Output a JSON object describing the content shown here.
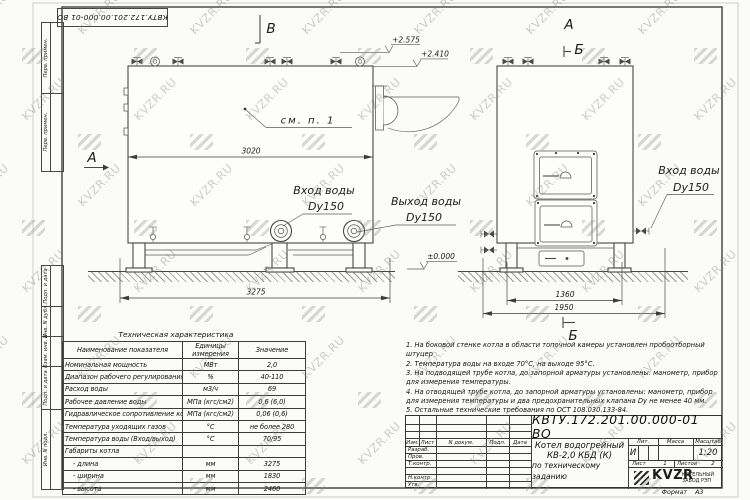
{
  "watermark": {
    "text": "KVZR.RU"
  },
  "margin": {
    "stamp": "КВТУ.172.201.00.000-01 ВО",
    "top_labels": [
      "Перв. примен.",
      "Перв. примен."
    ],
    "bottom_labels": [
      "Подп. и дата",
      "Инв. N дубл.",
      "Взам. инв. N",
      "Подп. и дата",
      "Инв. N подл."
    ]
  },
  "views": {
    "label_a_left": "А",
    "label_a_right": "А",
    "label_v_view": "В",
    "label_b_section_top": "Б",
    "label_b_section_bottom": "Б",
    "see_note": "см. п. 1",
    "dim_3020": "3020",
    "dim_3275": "3275",
    "dim_1360": "1360",
    "dim_1950": "1950",
    "elev_1": "+2.575",
    "elev_2": "+2.410",
    "elev_zero": "±0.000",
    "inlet_left_label": "Вход воды",
    "inlet_left_size": "Dy150",
    "outlet_label": "Выход воды",
    "outlet_size": "Dy150",
    "inlet_right_label": "Вход воды",
    "inlet_right_size": "Dy150"
  },
  "tech_table": {
    "title": "Техническая характеристика",
    "headers": [
      "Наименование показателя",
      "Единицы измерения",
      "Значение"
    ],
    "rows": [
      [
        "Номинальная мощность",
        "МВт",
        "2,0"
      ],
      [
        "Диапазон рабочего регулирования",
        "%",
        "40-110"
      ],
      [
        "Расход воды",
        "м3/ч",
        "69"
      ],
      [
        "Рабочее давление воды",
        "МПа (кгс/см2)",
        "0,6 (6,0)"
      ],
      [
        "Гидравлическое сопротивление котла",
        "МПа (кгс/см2)",
        "0,06 (0,6)"
      ],
      [
        "Температура уходящих газов",
        "°С",
        "не более 280"
      ],
      [
        "Температура воды (Вход/выход)",
        "°С",
        "70/95"
      ],
      [
        "Габариты котла",
        "",
        ""
      ],
      [
        "    - длина",
        "мм",
        "3275"
      ],
      [
        "    - ширина",
        "мм",
        "1830"
      ],
      [
        "    - высота",
        "мм",
        "2460"
      ]
    ]
  },
  "notes": [
    "1.  На боковой стенке котла в области топочной камеры установлен пробоотборный штуцер",
    "2.  Температура воды на входе 70°С, на выходе 95°С.",
    "3.  На подводящей трубе котла, до запорной арматуры установлены: манометр, прибор для измерения температуры.",
    "4.  На отводящей трубе котла, до запорной арматуры установлены: манометр, прибор для измерения температуры и два предохранительных клапана Dу не менее 40 мм.",
    "5.  Остальные технические требования по ОСТ 108.030.133-84."
  ],
  "title_block": {
    "doc_number": "КВТУ.172.201.00.000-01 ВО",
    "header_cells": [
      "Изм.",
      "Лист",
      "N докум.",
      "Подп.",
      "Дата"
    ],
    "row_labels": [
      "Разраб.",
      "Пров.",
      "Т.контр.",
      "Н.контр.",
      "Утв."
    ],
    "product_title_1": "Котел водогрейный",
    "product_title_2": "КВ-2,0 КБД (К)",
    "product_title_3": "по техническому заданию",
    "lit_label": "Лит.",
    "lit_value": "И",
    "mass_label": "Масса",
    "scale_label": "Масштаб",
    "scale_value": "1:20",
    "sheet_label": "Лист",
    "sheet_value": "1",
    "sheets_label": "Листов",
    "sheets_value": "2",
    "logo_text": "KVZR",
    "company_line1": "КОТЕЛЬНЫЙ",
    "company_line2": "ЗАВОД РЭП",
    "format_label": "Формат",
    "format_value": "А3"
  }
}
